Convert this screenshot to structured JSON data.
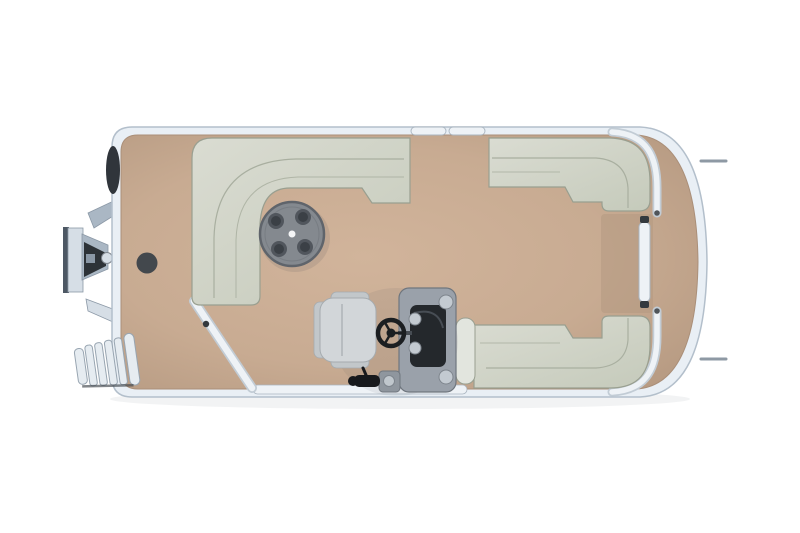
{
  "colors": {
    "background": "#ffffff",
    "shadow": "#2a3340",
    "hull_rim": "#e9eff5",
    "hull_stroke": "#b3bfcb",
    "deck_center": "#d1b49b",
    "deck": "#c8ab92",
    "deck_edge": "#b3977f",
    "deck_stroke": "#aa8f79",
    "walkway_shade": "#b1977f",
    "seat_light": "#dadcd2",
    "seat": "#c6cbbc",
    "seat_stroke": "#999f90",
    "seat_seam": "#a9afa0",
    "seat_armrest": "#e2e5de",
    "rail_fill": "#eef2f6",
    "rail_base": "#c2ccd5",
    "rail_stroke": "#aab5c0",
    "hinge": "#34393e",
    "cleat": "#8e99a4",
    "table_top": "#84898f",
    "table_rim": "#5f646b",
    "table_ring": "#6f747b",
    "cupholder": "#51565d",
    "cupholder_inner": "#3b4046",
    "table_dot": "#f4f5f6",
    "deck_plug": "#43484d",
    "console_body": "#9aa1aa",
    "console_stroke": "#6f767e",
    "console_panel": "#24282c",
    "console_sheen": "#474d54",
    "console_knob": "#c3cad1",
    "knob_stroke": "#7e858d",
    "wheel": "#1b1e21",
    "chair_body": "#d2d6d9",
    "chair_shade": "#c2c7ca",
    "chair_stroke": "#a5abaf",
    "throttle_base": "#8f969e",
    "throttle_dark": "#17191c",
    "throttle_silver": "#c0c7cd",
    "motor_light": "#d6dee6",
    "motor_mid": "#aab7c4",
    "motor_dark": "#2d3237",
    "motor_stroke": "#8b98a6",
    "motor_plate": "#4d5864",
    "cowl": "#30353b",
    "ladder_fill": "#e6ecf1",
    "ladder_stroke": "#98a5b1",
    "ladder_dark": "#3f454b"
  },
  "table": {
    "cupholder_count": 4
  }
}
